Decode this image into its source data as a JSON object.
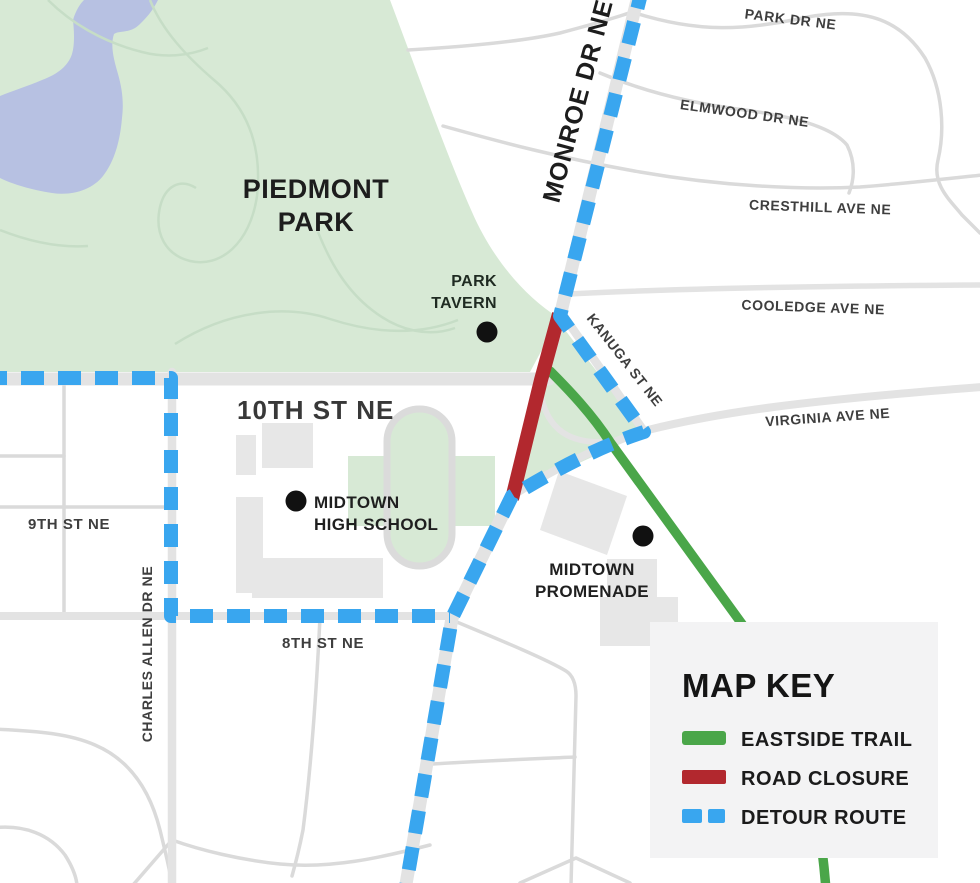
{
  "colors": {
    "background": "#ffffff",
    "park-green": "#d7e9d5",
    "lake-blue": "#b7c1e2",
    "path-green": "#c6ddc6",
    "road-gray": "#e3e3e3",
    "road-thin-gray": "#dadada",
    "building-gray": "#e7e7e7",
    "track-gray": "#dbdbdb",
    "eastside-trail": "#4aa649",
    "road-closure": "#b2282e",
    "detour-route": "#39a6ef",
    "key-panel": "#f3f3f4",
    "street-label": "#3e3e3e",
    "dark-label": "#1d1d1d",
    "marker-black": "#111111"
  },
  "streets": {
    "park_dr": "PARK DR NE",
    "elmwood": "ELMWOOD DR NE",
    "cresthill": "CRESTHILL AVE NE",
    "cooledge": "COOLEDGE AVE NE",
    "virginia": "VIRGINIA AVE NE",
    "kanuga": "KANUGA ST NE",
    "monroe": "MONROE DR NE",
    "tenth": "10TH ST NE",
    "ninth": "9TH ST NE",
    "eighth": "8TH ST NE",
    "charles_allen": "CHARLES ALLEN DR NE"
  },
  "places": {
    "piedmont_park": {
      "line1": "PIEDMONT",
      "line2": "PARK"
    },
    "park_tavern": {
      "line1": "PARK",
      "line2": "TAVERN"
    },
    "midtown_high_school": {
      "line1": "MIDTOWN",
      "line2": "HIGH SCHOOL"
    },
    "midtown_promenade": {
      "line1": "MIDTOWN",
      "line2": "PROMENADE"
    }
  },
  "map_key": {
    "title": "MAP KEY",
    "items": [
      {
        "label": "EASTSIDE TRAIL",
        "swatch": "solid-green",
        "color": "#4aa649"
      },
      {
        "label": "ROAD CLOSURE",
        "swatch": "solid-red",
        "color": "#b2282e"
      },
      {
        "label": "DETOUR ROUTE",
        "swatch": "dashed-blue",
        "color": "#39a6ef"
      }
    ]
  }
}
